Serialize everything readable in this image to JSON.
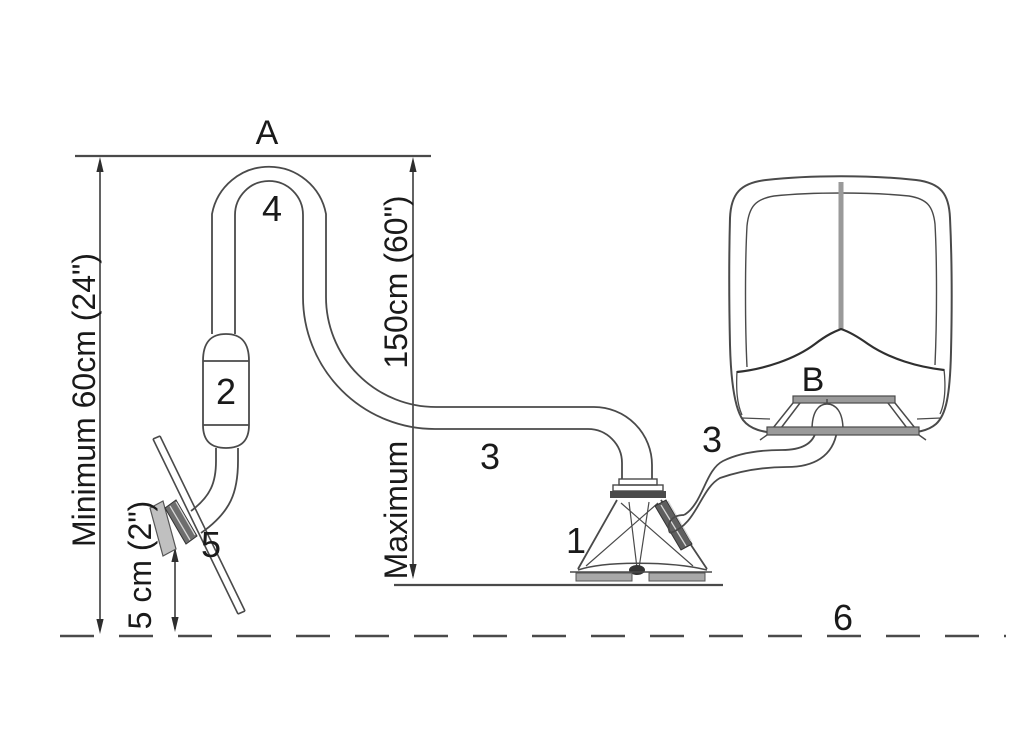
{
  "diagram": {
    "type": "installation-diagram",
    "labels": {
      "point_a": "A",
      "point_b": "B",
      "part_1": "1",
      "part_2": "2",
      "part_3_left": "3",
      "part_3_right": "3",
      "part_4": "4",
      "part_5": "5",
      "part_6": "6"
    },
    "dimensions": {
      "minimum_height": "Minimum 60cm (24\")",
      "maximum_value": "150cm (60\")",
      "maximum_word": "Maximum",
      "clearance": "5 cm (2\")"
    },
    "colors": {
      "line": "#4a4a4a",
      "text": "#1a1a1a",
      "gray_fill": "#9a9a9a",
      "dark_fill": "#555555",
      "background": "#ffffff"
    }
  }
}
